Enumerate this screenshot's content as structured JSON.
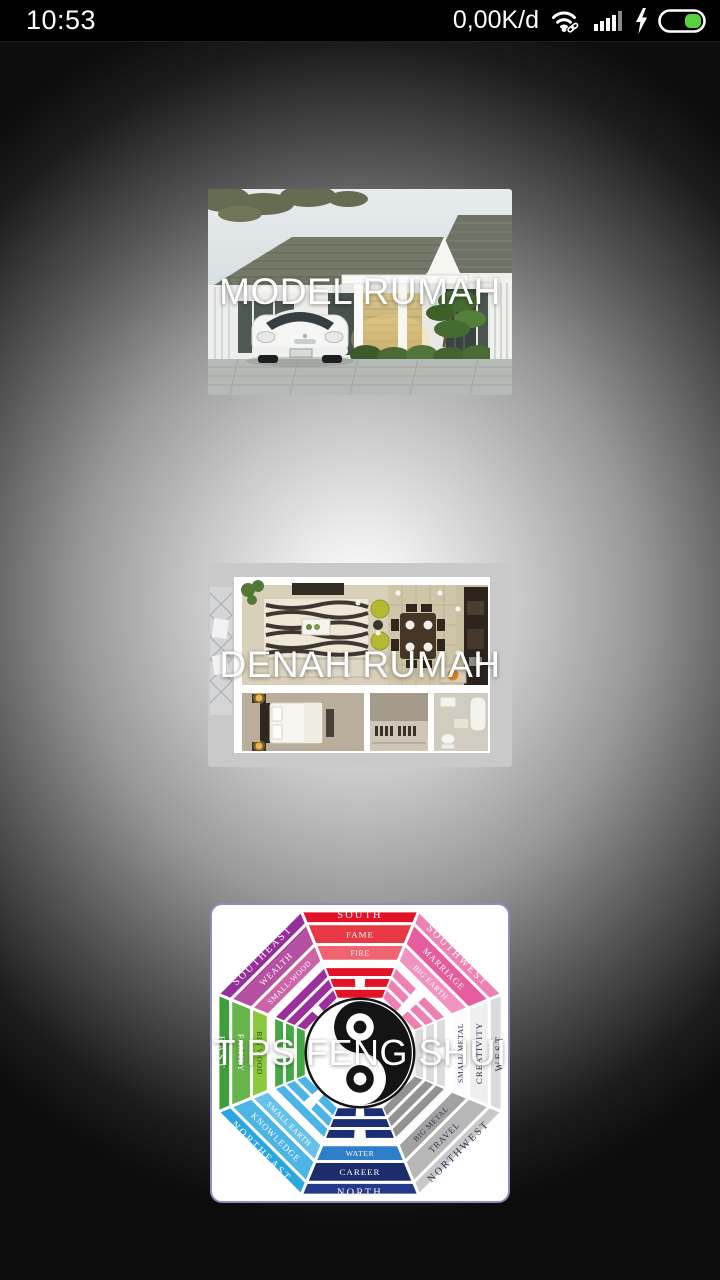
{
  "status_bar": {
    "time": "10:53",
    "data_rate": "0,00K/d",
    "wifi_icon": "wifi-connected-with-link",
    "signal_bars_total": 5,
    "signal_bars_active": 4,
    "charging": true,
    "battery_level_percent": 40,
    "battery_fill_color": "#57d23e",
    "icon_color": "#ffffff",
    "signal_dim_color": "#8a8a8a"
  },
  "menu": {
    "cards": [
      {
        "id": "model-rumah",
        "title": "MODEL RUMAH",
        "image": "minimalist-house-photo"
      },
      {
        "id": "denah-rumah",
        "title": "DENAH RUMAH",
        "image": "3d-floor-plan-top-view"
      },
      {
        "id": "tips-feng-shui",
        "title": "TIPS FENG SHUI",
        "image": "feng-shui-bagua-diagram"
      }
    ]
  },
  "bagua": {
    "center_symbol": "yin-yang",
    "card_border_color": "#8d8dc2",
    "text_dark": "#30304e",
    "segments": [
      {
        "dir": "SOUTH",
        "aspect": "FAME",
        "element": "FIRE",
        "colors": [
          "#e31226",
          "#e63944",
          "#ef6470"
        ],
        "trigram_color": "#e31226",
        "text": "#ffffff",
        "trigram": "sbs"
      },
      {
        "dir": "SOUTHWEST",
        "aspect": "MARRIAGE",
        "element": "BIG EARTH",
        "colors": [
          "#ef82b5",
          "#e75c9f",
          "#f193c1"
        ],
        "trigram_color": "#ee7fb2",
        "text": "#ffffff",
        "trigram": "bbb"
      },
      {
        "dir": "WEST",
        "aspect": "CREATIVITY",
        "element": "SMALL METAL",
        "colors": [
          "#dadada",
          "#efefef",
          "#fbfbfb"
        ],
        "trigram_color": "#dcdcdc",
        "text": "#30304e",
        "trigram": "ssb"
      },
      {
        "dir": "NORTHWEST",
        "aspect": "TRAVEL",
        "element": "BIG METAL",
        "colors": [
          "#c8c8c8",
          "#b7b7b7",
          "#a2a2a2"
        ],
        "trigram_color": "#929292",
        "text": "#30304e",
        "trigram": "sss"
      },
      {
        "dir": "NORTH",
        "aspect": "CAREER",
        "element": "WATER",
        "colors": [
          "#25398a",
          "#1d2c6b",
          "#2e7ecb"
        ],
        "trigram_color": "#1d2f74",
        "text": "#ffffff",
        "trigram": "bsb"
      },
      {
        "dir": "NORTHEAST",
        "aspect": "KNOWLEDGE",
        "element": "SMALL EARTH",
        "colors": [
          "#2aa6e0",
          "#4db4e6",
          "#66c2ea"
        ],
        "trigram_color": "#4ab4e6",
        "text": "#ffffff",
        "trigram": "bbs"
      },
      {
        "dir": "EAST",
        "aspect": "FAMILY",
        "element": "BIG WOOD",
        "colors": [
          "#3f9e3a",
          "#68b44c",
          "#8cc83e"
        ],
        "trigram_color": "#46a844",
        "text": "#ffffff",
        "text_element": "#2b5520",
        "trigram": "sbb"
      },
      {
        "dir": "SOUTHEAST",
        "aspect": "WEALTH",
        "element": "SMALL-WOOD",
        "colors": [
          "#962f99",
          "#b4509f",
          "#cd64a8"
        ],
        "trigram_color": "#9c2f9c",
        "text": "#ffffff",
        "trigram": "bss"
      }
    ]
  }
}
